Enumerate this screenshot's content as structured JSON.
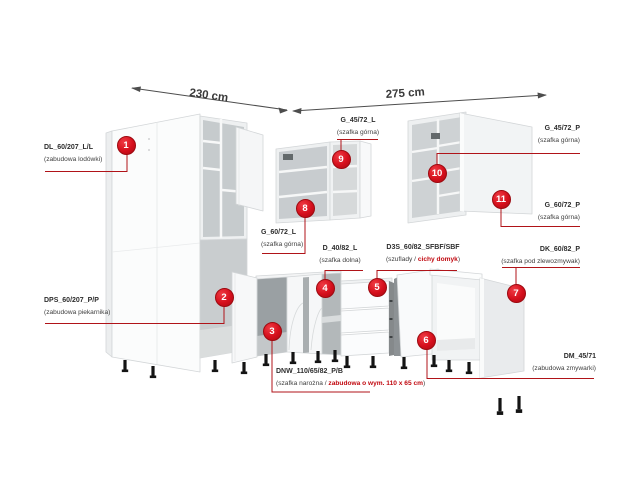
{
  "dimensions": {
    "left": "230 cm",
    "right": "275 cm"
  },
  "colors": {
    "accent_red": "#d50f1c",
    "label_red": "#c1080f",
    "leader_red": "#b01318"
  },
  "items": [
    {
      "num": "1",
      "code": "DL_60/207_L/L",
      "desc_prefix": "(zabudowa lodówki)",
      "desc_red": "",
      "desc_suffix": ""
    },
    {
      "num": "2",
      "code": "DPS_60/207_P/P",
      "desc_prefix": "(zabudowa piekarnika)",
      "desc_red": "",
      "desc_suffix": ""
    },
    {
      "num": "3",
      "code": "DNW_110/65/82_P/B",
      "desc_prefix": "(szafka narożna / ",
      "desc_red": "zabudowa o wym. 110 x 65 cm",
      "desc_suffix": ")"
    },
    {
      "num": "4",
      "code": "D_40/82_L",
      "desc_prefix": "(szafka dolna)",
      "desc_red": "",
      "desc_suffix": ""
    },
    {
      "num": "5",
      "code": "D3S_60/82_SFBF/SBF",
      "desc_prefix": "(szuflady / ",
      "desc_red": "cichy domyk",
      "desc_suffix": ")"
    },
    {
      "num": "6",
      "code": "DM_45/71",
      "desc_prefix": "(zabudowa zmywarki)",
      "desc_red": "",
      "desc_suffix": ""
    },
    {
      "num": "7",
      "code": "DK_60/82_P",
      "desc_prefix": "(szafka pod zlewozmywak)",
      "desc_red": "",
      "desc_suffix": ""
    },
    {
      "num": "8",
      "code": "G_60/72_L",
      "desc_prefix": "(szafka górna)",
      "desc_red": "",
      "desc_suffix": ""
    },
    {
      "num": "9",
      "code": "G_45/72_L",
      "desc_prefix": "(szafka górna)",
      "desc_red": "",
      "desc_suffix": ""
    },
    {
      "num": "10",
      "code": "G_45/72_P",
      "desc_prefix": "(szafka górna)",
      "desc_red": "",
      "desc_suffix": ""
    },
    {
      "num": "11",
      "code": "G_60/72_P",
      "desc_prefix": "(szafka górna)",
      "desc_red": "",
      "desc_suffix": ""
    }
  ]
}
